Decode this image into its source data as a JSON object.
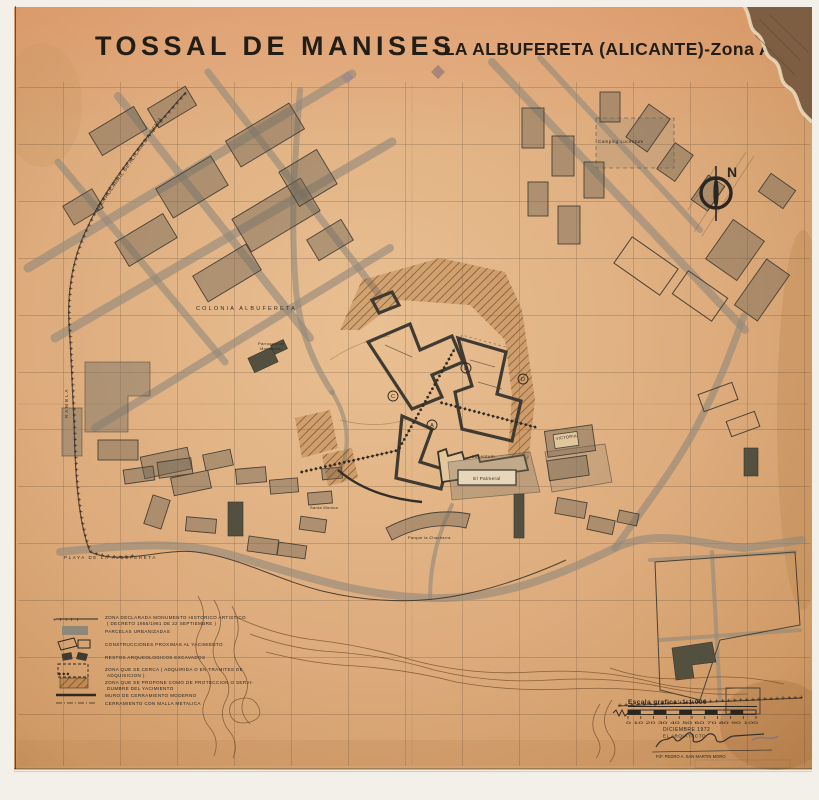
{
  "title": {
    "main": "TOSSAL DE MANISES",
    "subtitle": "- LA ALBUFERETA (ALICANTE)-Zona Arqueolog"
  },
  "compass": {
    "north": "N"
  },
  "map_labels": {
    "ferrocarril": "FERROCARRIL DE ALICANTE A DENIA",
    "colonia": "COLONIA ALBUFERETA",
    "camping": "Camping Lucentum",
    "playa": "PLAYA DE LA ALBUFERETA",
    "rambla": "RAMBLA",
    "parroquia_line1": "Parroquia de",
    "parroquia_line2": "Montserrat",
    "lucentum": "Lucentum",
    "victoria": "VICTORIA",
    "palmeral": "El Palmeral",
    "parque": "Parque la Chacharra",
    "santa_monica": "Santa Monica"
  },
  "site_markers": {
    "a": "A",
    "b": "B",
    "c": "C",
    "d": "D"
  },
  "legend": {
    "items": [
      {
        "line1": "ZONA DECLARADA MONUMENTO HISTORICO ARTISTICO",
        "line2": "( DECRETO 1955/1961 DE 22 SEPTIEMBRE )"
      },
      {
        "line1": "PARCELAS URBANIZADAS",
        "line2": ""
      },
      {
        "line1": "CONSTRUCCIONES PROXIMAS AL YACIMIENTO",
        "line2": ""
      },
      {
        "line1": "RESTOS ARQUEOLOGICOS EXCAVADOS",
        "line2": ""
      },
      {
        "line1": "ZONA QUE SE CERCA ( ADQUIRIDA O EN TRAMITES DE",
        "line2": "ADQUISICION )"
      },
      {
        "line1": "ZONA QUE SE PROPONE COMO DE PROTECCION O SERVI-",
        "line2": "DUMBRE DEL YACIMIENTO"
      },
      {
        "line1": "MURO DE CERRAMIENTO MODERNO",
        "line2": ""
      },
      {
        "line1": "CERRAMIENTO CON MALLA METALICA",
        "line2": ""
      }
    ]
  },
  "scale": {
    "label": "Escala grafica: 1:1.000",
    "ticks_text": "0   10   20   30   40   50   60   70   80   90   100"
  },
  "stamp": {
    "date": "DICIEMBRE  1972",
    "role": "EL  ARQUITECTO:",
    "name": "Fdº:  PEDRO  A.  SAN  MARTIN  MORO"
  },
  "symbols": {
    "plus_run": "+  +  +  +  +  +  +  +  +  +  +  +  +  +  +  +  +  +  +  +  +  +  +  +  +  +  +  +  +  +  +  +  +  +  +  +  +  +  +  +  +  +  +  +  +  +  +  +  +  +  +  +  +  +  +  +  +  +  +  +  +  +  +  +  +  +  +  +  +  +  +  +  +  +  +  +  +  +  +  +  +  +  +  +  +  +  +  +  +  +",
    "diamond_run": "◆   ◆   ◆   ◆   ◆   ◆   ◆   ◆   ◆   ◆   ◆   ◆   ◆   ◆   ◆   ◆   ◆   ◆   ◆   ◆   ◆   ◆   ◆   ◆   ◆   ◆   ◆   ◆   ◆   ◆   ◆   ◆   ◆   ◆   ◆   ◆   ◆   ◆   ◆   ◆   ◆   ◆   ◆   ◆   ◆",
    "plus_short": "+   +   +   +   +",
    "diamond_short": "◆    ◆    ◆"
  },
  "colors": {
    "paper": "#dcab7c",
    "ink": "#2b2620",
    "parcel_gray": "#8f8878",
    "hatch_brown": "#7d4e1f"
  }
}
